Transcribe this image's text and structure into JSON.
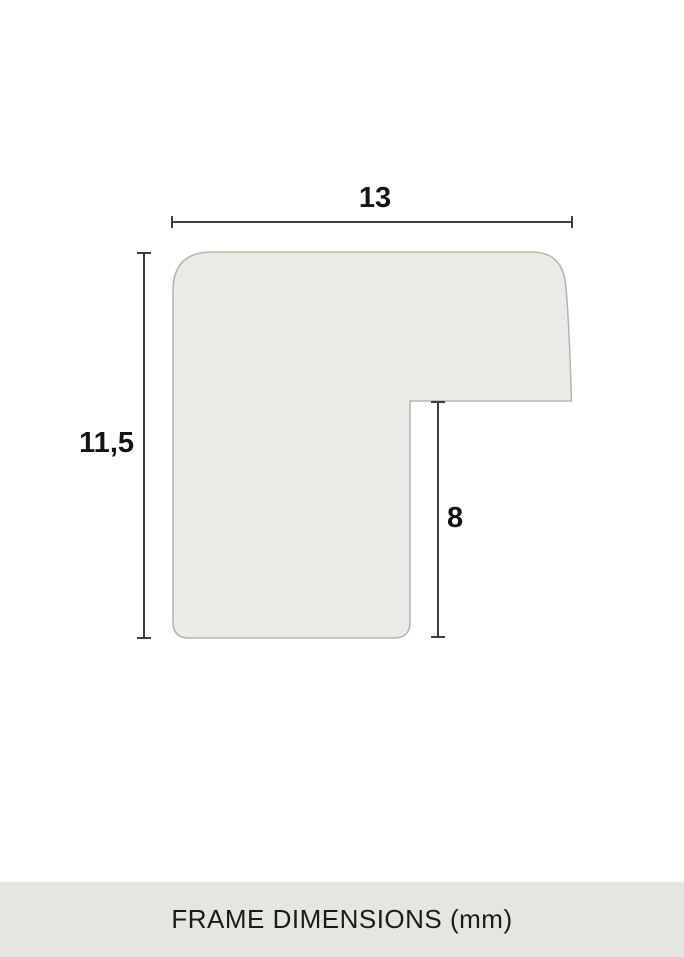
{
  "colors": {
    "background": "#ffffff",
    "shape-fill": "#eaebe6",
    "shape-border": "#b3b4b0",
    "dimension-line": "#3d3e3e",
    "label-text": "#141414",
    "caption-bar-bg": "#e5e6e1",
    "caption-text": "#1b1b1b"
  },
  "diagram": {
    "dimensions": [
      {
        "name": "width",
        "value": "13"
      },
      {
        "name": "height",
        "value": "11,5"
      },
      {
        "name": "rabbet-height",
        "value": "8"
      }
    ]
  },
  "caption": {
    "text": "FRAME DIMENSIONS (mm)"
  }
}
